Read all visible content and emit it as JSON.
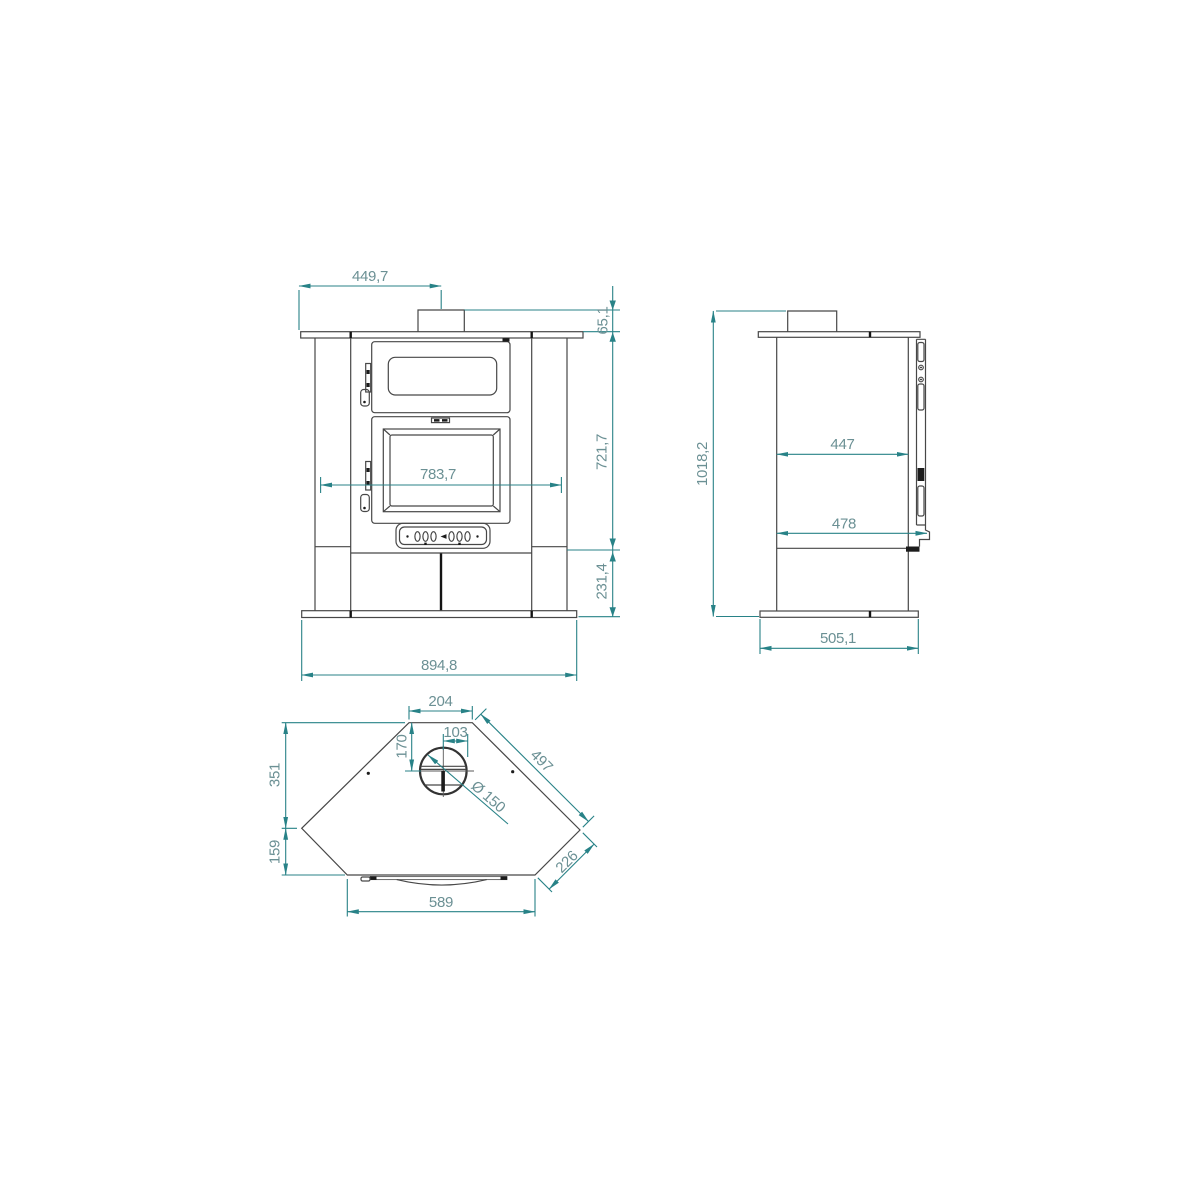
{
  "colors": {
    "dimension_line": "#288287",
    "dimension_text": "#6b9094",
    "object_line": "#474747",
    "accent_dark": "#141414",
    "background": "#ffffff"
  },
  "views": {
    "front": {
      "dims": {
        "chimney_offset_width": "449,7",
        "collar_height": "65,1",
        "body_height": "721,7",
        "inner_width": "783,7",
        "base_height": "231,4",
        "overall_width": "894,8"
      }
    },
    "side": {
      "dims": {
        "overall_height": "1018,2",
        "depth_upper": "447",
        "depth_lower": "478",
        "base_depth": "505,1"
      }
    },
    "top": {
      "dims": {
        "flue_panel_width": "204",
        "flue_offset_depth": "170",
        "flue_offset_right": "103",
        "side_panel_length": "497",
        "flue_diameter": "Ø 150",
        "left_depth_upper": "351",
        "left_depth_lower": "159",
        "corner_cut_length": "226",
        "front_panel_width": "589"
      }
    }
  }
}
